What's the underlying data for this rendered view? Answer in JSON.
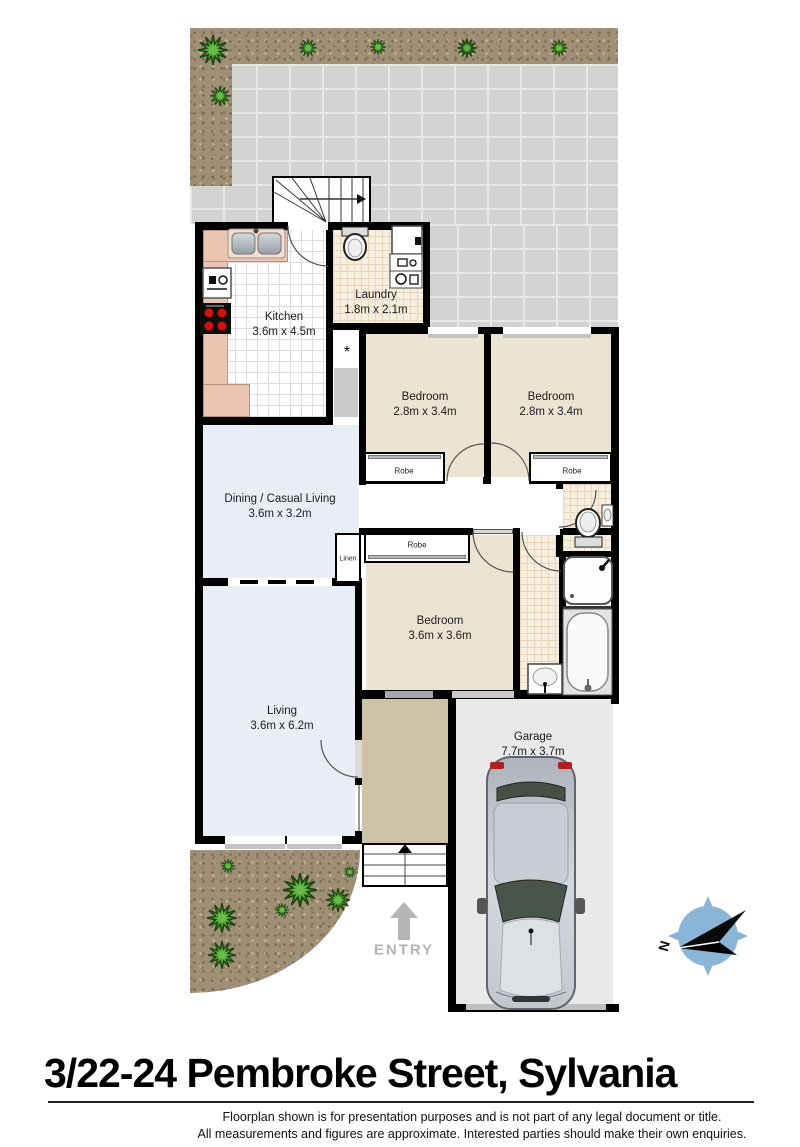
{
  "title": "3/22-24 Pembroke Street, Sylvania",
  "disclaimer": {
    "line1": "Floorplan shown is for presentation purposes and is not part of any legal document or title.",
    "line2": "All measurements and figures are approximate. Interested parties should make their own enquiries."
  },
  "rooms": {
    "kitchen": {
      "name": "Kitchen",
      "dims": "3.6m x 4.5m"
    },
    "laundry": {
      "name": "Laundry",
      "dims": "1.8m x 2.1m"
    },
    "bedroom1": {
      "name": "Bedroom",
      "dims": "2.8m x 3.4m"
    },
    "bedroom2": {
      "name": "Bedroom",
      "dims": "2.8m x 3.4m"
    },
    "bedroom3": {
      "name": "Bedroom",
      "dims": "3.6m x 3.6m"
    },
    "dining": {
      "name": "Dining / Casual Living",
      "dims": "3.6m x 3.2m"
    },
    "living": {
      "name": "Living",
      "dims": "3.6m x 6.2m"
    },
    "garage": {
      "name": "Garage",
      "dims": "7.7m x 3.7m"
    }
  },
  "closets": {
    "robe": "Robe",
    "linen": "Linen"
  },
  "entry": {
    "label": "ENTRY"
  },
  "lobby_marker": "*",
  "compass": {
    "label": "N"
  },
  "colors": {
    "wall": "#000000",
    "bedroom_floor": "#ece4d3",
    "living_floor": "#e9eef6",
    "kitchen_counter": "#eac5b0",
    "tile_floor": "#f7eedd",
    "entry_floor": "#cdc2a8",
    "garage_floor": "#e9e9e9",
    "paving": "#d2d4d1",
    "dirt": "#9e8f76",
    "plant_green": "#3f9328",
    "stove_burner_red": "#cf1212",
    "compass_blue": "#8ab5d6",
    "entry_arrow_gray": "#b3b3b3"
  }
}
